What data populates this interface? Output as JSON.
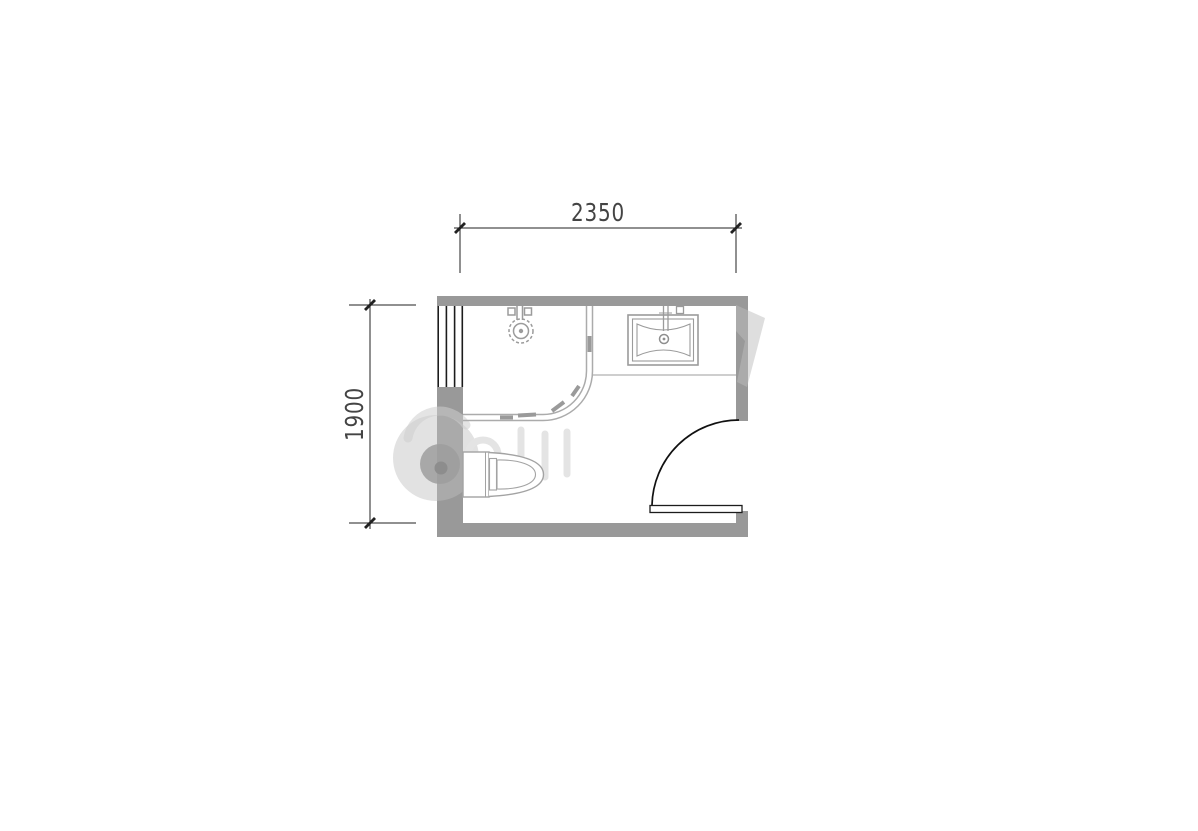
{
  "dimensions": {
    "width_label": "2350",
    "height_label": "1900"
  },
  "colors": {
    "background": "#ffffff",
    "wall_fill": "#999999",
    "fixture_line": "#a0a0a0",
    "ink_line": "#1c1c1c",
    "dimension_ink": "#444444",
    "watermark_light": "#d6d6d6",
    "watermark_on_wall": "#b5b5b5"
  },
  "fixtures": {
    "window": "window",
    "shower_enclosure": "curved-shower-enclosure",
    "shower_head": "shower-head",
    "washbasin": "washbasin",
    "vanity_counter": "vanity-counter",
    "toilet": "toilet",
    "door": "door-swing"
  }
}
